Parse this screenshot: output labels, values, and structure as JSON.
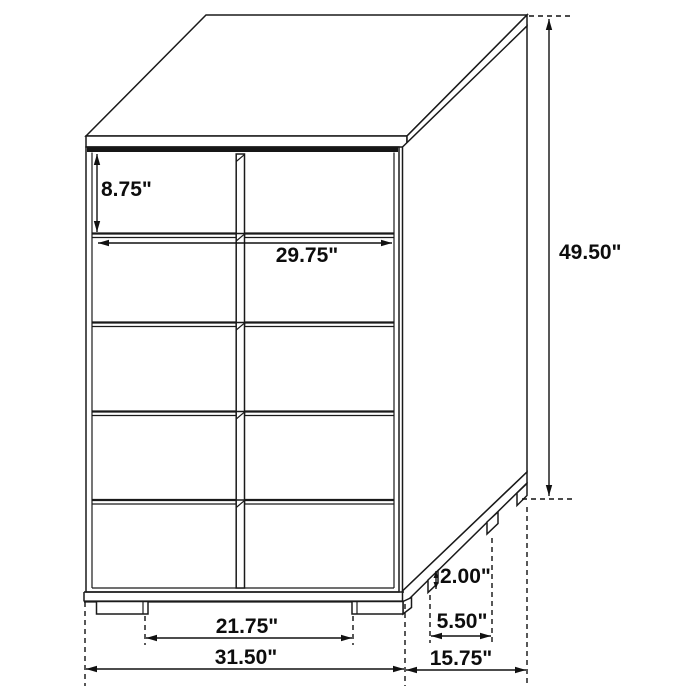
{
  "figure": {
    "subject": "chest-of-drawers dimension diagram",
    "description": "3D perspective technical line drawing of a 5-row, 2-column drawer chest with dimension callouts",
    "units": "inches",
    "style": "black line art on white background",
    "colors": {
      "background": "#ffffff",
      "ink": "#1a1a1a",
      "label": "#0d0d0d"
    },
    "drawer_rows": 5,
    "drawer_columns": 2
  },
  "dims": {
    "drawer_height": "8.75\"",
    "front_width": "29.75\"",
    "overall_height": "49.50\"",
    "foot_height": "2.00\"",
    "side_foot_spacing": "5.50\"",
    "front_foot_spacing": "21.75\"",
    "overall_width": "31.50\"",
    "overall_depth": "15.75\""
  }
}
